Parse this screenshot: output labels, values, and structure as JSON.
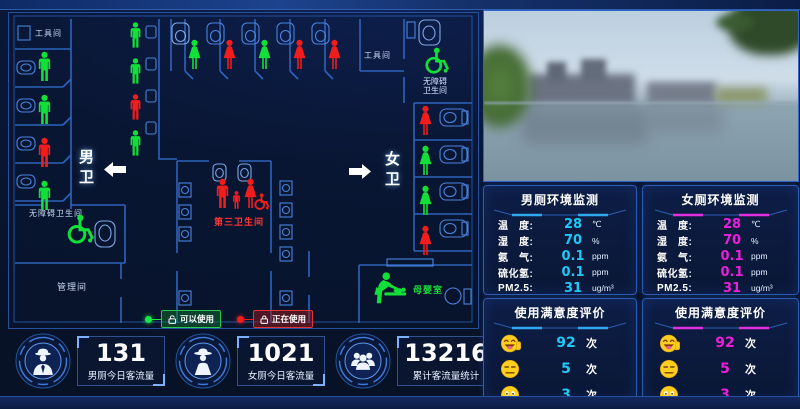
{
  "floorplan": {
    "rooms": {
      "tool_room": "工具间",
      "mens": "男卫",
      "womens": "女卫",
      "accessible_top_1": "无障碍",
      "accessible_top_2": "卫生间",
      "accessible_left": "无障碍卫生间",
      "third_restroom": "第三卫生间",
      "management": "管理间",
      "baby_room": "母婴室"
    },
    "legend": {
      "available": "可以使用",
      "occupied": "正在使用"
    },
    "occupancy": {
      "mens_left_stalls": [
        "free",
        "free",
        "busy",
        "free"
      ],
      "mens_urinals": [
        "free",
        "free",
        "busy",
        "free"
      ],
      "womens_top_stalls": [
        "free",
        "busy",
        "free",
        "busy",
        "busy"
      ],
      "womens_right_stalls": [
        "busy",
        "free",
        "free",
        "busy"
      ]
    },
    "colors": {
      "free": "#12df38",
      "busy": "#f11c1c"
    }
  },
  "stats": [
    {
      "value": "131",
      "label": "男厕今日客流量",
      "icon": "man-with-hat-icon"
    },
    {
      "value": "1021",
      "label": "女厕今日客流量",
      "icon": "woman-with-hat-icon"
    },
    {
      "value": "13216",
      "label": "累计客流量统计",
      "icon": "people-group-icon"
    }
  ],
  "env_panels": [
    {
      "title": "男厕环境监测",
      "accent": "#1fc9f7",
      "rows": [
        {
          "label": "温　度:",
          "value": "28",
          "unit": "℃"
        },
        {
          "label": "湿　度:",
          "value": "70",
          "unit": "%"
        },
        {
          "label": "氨　气:",
          "value": "0.1",
          "unit": "ppm"
        },
        {
          "label": "硫化氢:",
          "value": "0.1",
          "unit": "ppm"
        },
        {
          "label": "PM2.5:",
          "value": "31",
          "unit": "ug/m³"
        }
      ]
    },
    {
      "title": "女厕环境监测",
      "accent": "#ec1fd8",
      "rows": [
        {
          "label": "温　度:",
          "value": "28",
          "unit": "℃"
        },
        {
          "label": "湿　度:",
          "value": "70",
          "unit": "%"
        },
        {
          "label": "氨　气:",
          "value": "0.1",
          "unit": "ppm"
        },
        {
          "label": "硫化氢:",
          "value": "0.1",
          "unit": "ppm"
        },
        {
          "label": "PM2.5:",
          "value": "31",
          "unit": "ug/m³"
        }
      ]
    }
  ],
  "satisfaction_panels": [
    {
      "title": "使用满意度评价",
      "accent": "#1fc9f7",
      "rows": [
        {
          "face": "laughing",
          "value": "92",
          "unit": "次"
        },
        {
          "face": "neutral",
          "value": "5",
          "unit": "次"
        },
        {
          "face": "sad",
          "value": "3",
          "unit": "次"
        }
      ]
    },
    {
      "title": "使用满意度评价",
      "accent": "#ec1fd8",
      "rows": [
        {
          "face": "laughing",
          "value": "92",
          "unit": "次"
        },
        {
          "face": "neutral",
          "value": "5",
          "unit": "次"
        },
        {
          "face": "sad",
          "value": "3",
          "unit": "次"
        }
      ]
    }
  ]
}
